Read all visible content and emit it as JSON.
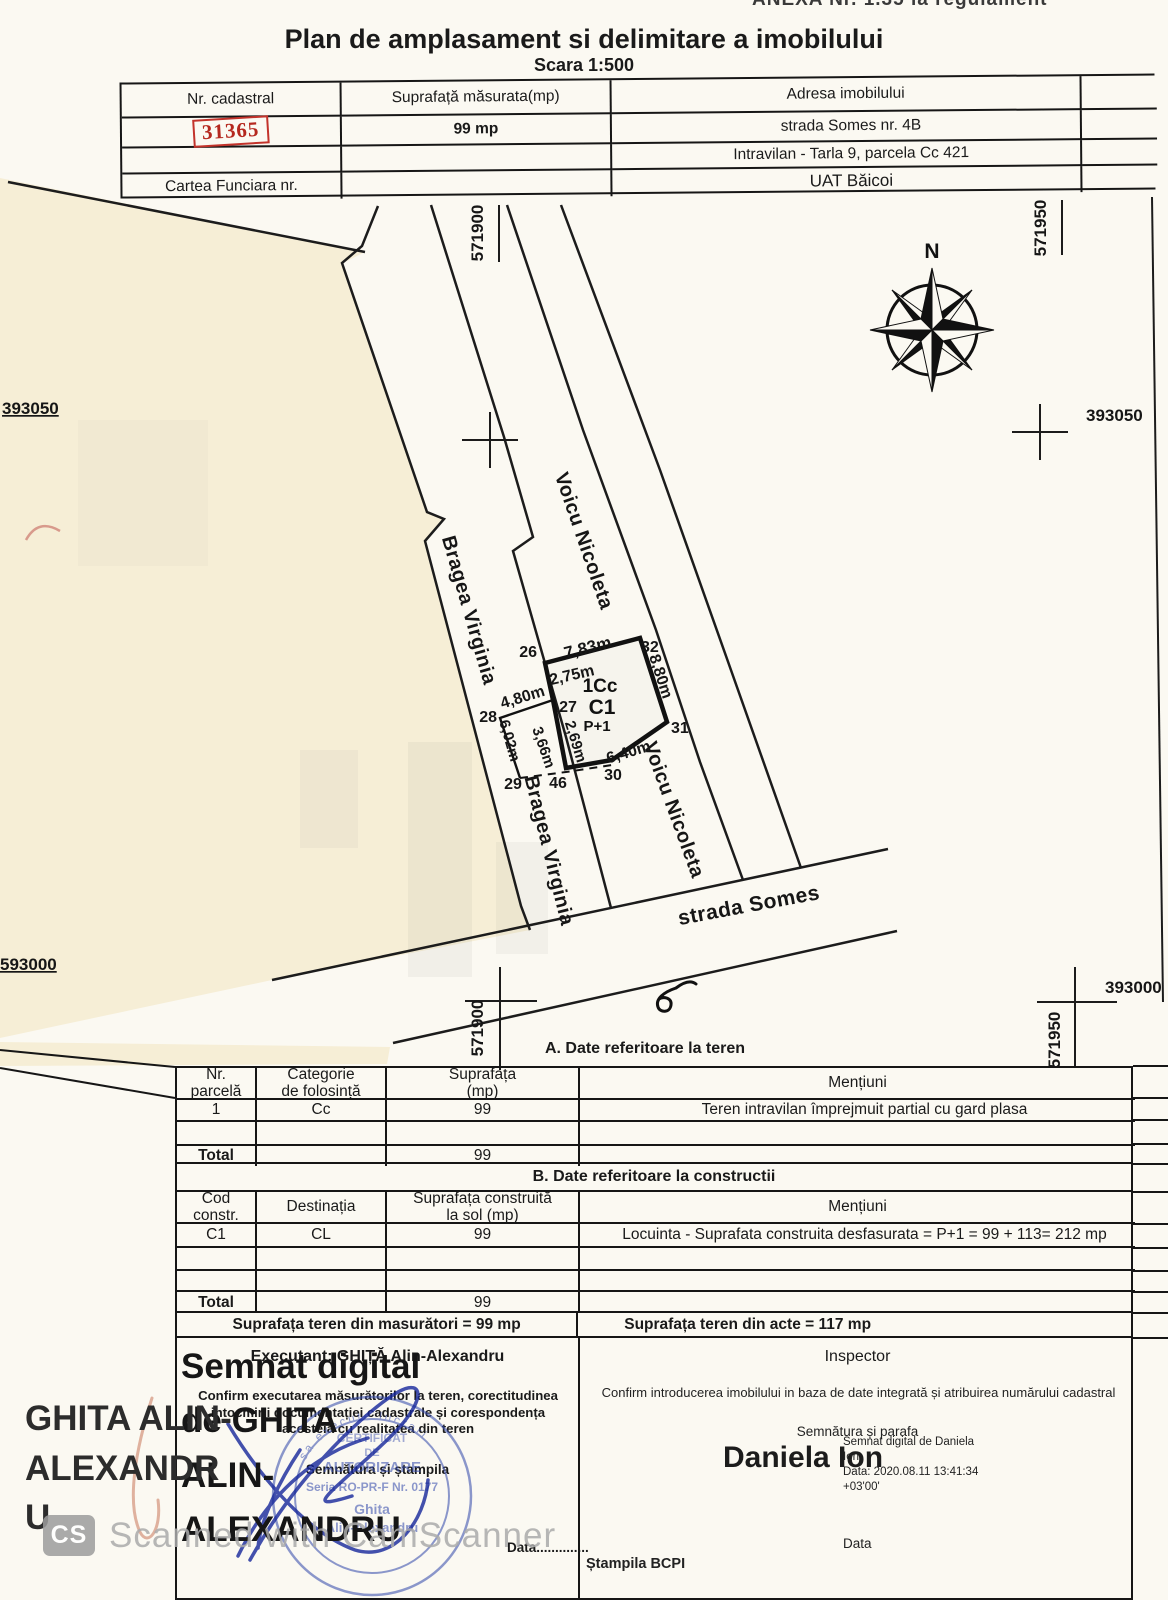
{
  "page": {
    "anexa": "ANEXA Nr. 1.35 la regulament",
    "title": "Plan de amplasament si delimitare a imobilului",
    "scale": "Scara 1:500"
  },
  "top_table": {
    "col1_header": "Nr. cadastral",
    "cadastral_value": "31365",
    "col2_header": "Suprafață măsurata(mp)",
    "area_value": "99 mp",
    "col3_header": "Adresa imobilului",
    "address_line1": "strada Somes nr. 4B",
    "address_line2": "Intravilan - Tarla 9, parcela Cc 421",
    "cartea_label": "Cartea Funciara nr.",
    "address_line3": "UAT  Băicoi"
  },
  "map": {
    "north": "N",
    "street": "strada Somes",
    "neighbor_bragea": "Bragea Virginia",
    "neighbor_voicu": "Voicu Nicoleta",
    "e571900": "571900",
    "e571950": "571950",
    "n393050": "393050",
    "n393000": "393000",
    "n593000": "593000",
    "parcel_code": "1Cc",
    "building_code": "C1",
    "building_floors": "P+1",
    "points": {
      "p26": "26",
      "p27": "27",
      "p28": "28",
      "p29": "29",
      "p30": "30",
      "p31": "31",
      "p32": "32",
      "p46": "46"
    },
    "dims": {
      "top": "7,83m",
      "d275": "2,75m",
      "d480": "4,80m",
      "right": "8,80m",
      "d602": "6,02m",
      "d366": "3,66m",
      "d269": "2,69m",
      "bottom": "6,40m"
    }
  },
  "section_a": {
    "title": "A. Date referitoare la teren",
    "headers": [
      "Nr.\nparcelă",
      "Categorie\nde folosință",
      "Suprafața\n(mp)",
      "Mențiuni"
    ],
    "row1": [
      "1",
      "Cc",
      "99",
      "Teren intravilan împrejmuit partial cu gard plasa"
    ],
    "total_label": "Total",
    "total_value": "99"
  },
  "section_b": {
    "title": "B. Date referitoare la constructii",
    "headers": [
      "Cod\nconstr.",
      "Destinația",
      "Suprafața construită\nla sol (mp)",
      "Mențiuni"
    ],
    "row1": [
      "C1",
      "CL",
      "99",
      "Locuinta - Suprafata construita desfasurata = P+1 = 99 + 113= 212 mp"
    ],
    "total_label": "Total",
    "total_value": "99"
  },
  "totals": {
    "masuratori": "Suprafața teren din masurători = 99 mp",
    "acte": "Suprafața teren din acte = 117 mp"
  },
  "executant": {
    "label": "Executant:  GHIȚĂ Alin-Alexandru",
    "confirm": "Confirm executarea măsurătorilor la teren, corectitudinea intocmirii documentației cadastrale și corespondența acesteia cu realitatea din teren",
    "signature_label": "Semnătura și ștampila",
    "date_label": "Data..............",
    "stamp": {
      "ring": "sa execute lucrari",
      "l1": "CERTIFICAT",
      "l2": "DE",
      "l3": "AUTORIZARE",
      "l4": "Seria RO-PR-F Nr. 0177",
      "l5": "Ghita",
      "l6": "Alin-Alexandru"
    },
    "digital_lines": [
      "Semnat digital",
      "de GHITA",
      "ALIN-",
      "ALEXANDRU"
    ]
  },
  "inspector": {
    "label": "Inspector",
    "confirm": "Confirm introducerea imobilului in baza de date integrată și atribuirea numărului cadastral",
    "signature_label": "Semnătura și parafa",
    "name": "Daniela Ion",
    "digital_lines": [
      "Semnat digital de Daniela",
      "Ion",
      "Data: 2020.08.11 13:41:34",
      "+03'00'"
    ],
    "date_label": "Data",
    "stamp_label": "Ștampila BCPI"
  },
  "margin_signer_lines": [
    "GHITA ALIN-",
    "ALEXANDR",
    "U"
  ],
  "watermark": {
    "logo": "CS",
    "text": "Scanned with CamScanner"
  }
}
